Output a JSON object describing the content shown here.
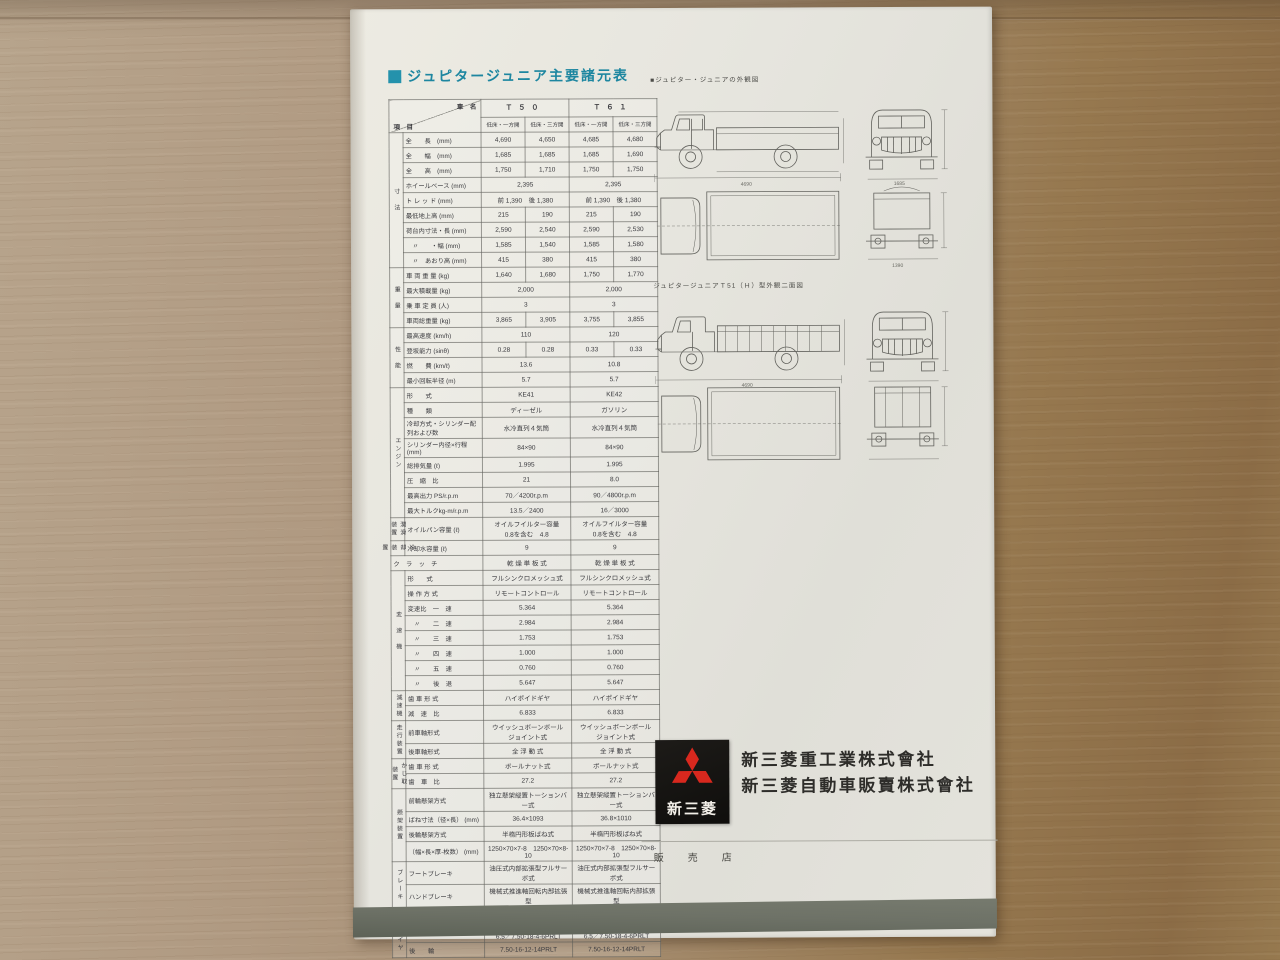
{
  "colors": {
    "accent_teal": "#2492ac",
    "logo_red": "#d8281e",
    "logo_black": "#141210",
    "band_gray": "#6a6e64",
    "paper": "#e6e5df",
    "ink": "#3a3a3e",
    "wood_light": "#b7a48c",
    "wood_dark": "#8b6c46"
  },
  "title": {
    "text": "ジュピタージュニア主要諸元表"
  },
  "drawings": {
    "caption1": "■ジュピター・ジュニアの外観図",
    "caption2": "ジュピタージュニアＴ51（Ｈ）型外観二面図",
    "dims": [
      "4690",
      "1685",
      "2395",
      "1750",
      "1390",
      "2000",
      "215",
      "1585"
    ]
  },
  "table": {
    "corner_top": "車　名",
    "corner_bottom": "項　目",
    "models": [
      "Ｔ５０",
      "Ｔ６１"
    ],
    "sub": [
      "低床・一方開",
      "低床・三方開",
      "低床・一方開",
      "低床・三方開"
    ],
    "sections": [
      {
        "name": "寸　法",
        "rows": [
          {
            "label": "全　　長　(mm)",
            "values": [
              "4,690",
              "4,650",
              "4,685",
              "4,680"
            ]
          },
          {
            "label": "全　　幅　(mm)",
            "values": [
              "1,685",
              "1,685",
              "1,685",
              "1,690"
            ]
          },
          {
            "label": "全　　高　(mm)",
            "values": [
              "1,750",
              "1,710",
              "1,750",
              "1,750"
            ]
          },
          {
            "label": "ホイールベース (mm)",
            "values": [
              "2,395",
              "2,395"
            ]
          },
          {
            "label": "ト レ ッ ド (mm)",
            "values": [
              "前 1,390　後 1,380",
              "前 1,390　後 1,380"
            ]
          },
          {
            "label": "最低地上高 (mm)",
            "values": [
              "215",
              "190",
              "215",
              "190"
            ]
          },
          {
            "label": "荷台内寸法・長 (mm)",
            "values": [
              "2,590",
              "2,540",
              "2,590",
              "2,530"
            ]
          },
          {
            "label": "　〃　　・幅 (mm)",
            "values": [
              "1,585",
              "1,540",
              "1,585",
              "1,580"
            ]
          },
          {
            "label": "　〃　あおり高 (mm)",
            "values": [
              "415",
              "380",
              "415",
              "380"
            ]
          }
        ]
      },
      {
        "name": "重　量",
        "rows": [
          {
            "label": "車 両 重 量 (kg)",
            "values": [
              "1,640",
              "1,680",
              "1,750",
              "1,770"
            ]
          },
          {
            "label": "最大積載量 (kg)",
            "values": [
              "2,000",
              "2,000"
            ]
          },
          {
            "label": "乗 車 定 員 (人)",
            "values": [
              "3",
              "3"
            ]
          },
          {
            "label": "車両総重量 (kg)",
            "values": [
              "3,865",
              "3,905",
              "3,755",
              "3,855"
            ]
          }
        ]
      },
      {
        "name": "性　能",
        "rows": [
          {
            "label": "最高速度 (km/h)",
            "values": [
              "110",
              "120"
            ]
          },
          {
            "label": "登坂能力 (sinθ)",
            "values": [
              "0.28",
              "0.28",
              "0.33",
              "0.33"
            ]
          },
          {
            "label": "燃　　費 (km/ℓ)",
            "values": [
              "13.6",
              "10.8"
            ]
          },
          {
            "label": "最小回転半径 (m)",
            "values": [
              "5.7",
              "5.7"
            ]
          }
        ]
      },
      {
        "name": "エンジン",
        "rows": [
          {
            "label": "形　　式",
            "values": [
              "KE41",
              "KE42"
            ]
          },
          {
            "label": "種　　類",
            "values": [
              "ディーゼル",
              "ガソリン"
            ]
          },
          {
            "label": "冷却方式・シリンダー配列および数",
            "values": [
              "水冷直列４気筒",
              "水冷直列４気筒"
            ]
          },
          {
            "label": "シリンダー内径×行程 (mm)",
            "values": [
              "84×90",
              "84×90"
            ]
          },
          {
            "label": "総排気量 (ℓ)",
            "values": [
              "1.995",
              "1.995"
            ]
          },
          {
            "label": "圧　縮　比",
            "values": [
              "21",
              "8.0"
            ]
          },
          {
            "label": "最高出力 PS/r.p.m",
            "values": [
              "70／4200r.p.m",
              "90／4800r.p.m"
            ]
          },
          {
            "label": "最大トルクkg-m/r.p.m",
            "values": [
              "13.5／2400",
              "16／3000"
            ]
          }
        ]
      },
      {
        "name": "潤滑装置",
        "rows": [
          {
            "label": "オイルパン容量 (ℓ)",
            "values": [
              "オイルフイルター容量\n0.8を含む　4.8",
              "オイルフイルター容量\n0.8を含む　4.8"
            ]
          }
        ]
      },
      {
        "name": "冷却装置",
        "rows": [
          {
            "label": "冷却水容量 (ℓ)",
            "values": [
              "9",
              "9"
            ]
          }
        ]
      },
      {
        "name": "",
        "rows": [
          {
            "label": "ク　ラ　ッ　チ",
            "values": [
              "乾 燥 単 板 式",
              "乾 燥 単 板 式"
            ]
          }
        ]
      },
      {
        "name": "変　速　機",
        "rows": [
          {
            "label": "形　　式",
            "values": [
              "フルシンクロメッシュ式",
              "フルシンクロメッシュ式"
            ]
          },
          {
            "label": "操 作 方 式",
            "values": [
              "リモートコントロール",
              "リモートコントロール"
            ]
          },
          {
            "label": "変速比　一　速",
            "values": [
              "5.364",
              "5.364"
            ]
          },
          {
            "label": "　〃　　二　速",
            "values": [
              "2.984",
              "2.984"
            ]
          },
          {
            "label": "　〃　　三　速",
            "values": [
              "1.753",
              "1.753"
            ]
          },
          {
            "label": "　〃　　四　速",
            "values": [
              "1.000",
              "1.000"
            ]
          },
          {
            "label": "　〃　　五　速",
            "values": [
              "0.760",
              "0.760"
            ]
          },
          {
            "label": "　〃　　後　退",
            "values": [
              "5.647",
              "5.647"
            ]
          }
        ]
      },
      {
        "name": "減速機",
        "rows": [
          {
            "label": "歯 車 形 式",
            "values": [
              "ハイポイドギヤ",
              "ハイポイドギヤ"
            ]
          },
          {
            "label": "減　速　比",
            "values": [
              "6.833",
              "6.833"
            ]
          }
        ]
      },
      {
        "name": "走行装置",
        "rows": [
          {
            "label": "前車軸形式",
            "values": [
              "ウイッシュボーンボール\nジョイント式",
              "ウイッシュボーンボール\nジョイント式"
            ]
          },
          {
            "label": "後車軸形式",
            "values": [
              "全 浮 動 式",
              "全 浮 動 式"
            ]
          }
        ]
      },
      {
        "name": "かじ取装置",
        "rows": [
          {
            "label": "歯 車 形 式",
            "values": [
              "ボールナット式",
              "ボールナット式"
            ]
          },
          {
            "label": "歯　車　比",
            "values": [
              "27.2",
              "27.2"
            ]
          }
        ]
      },
      {
        "name": "懸架装置",
        "rows": [
          {
            "label": "前輪懸架方式",
            "values": [
              "独立懸架縦置トーションバー式",
              "独立懸架縦置トーションバー式"
            ]
          },
          {
            "label": "ばね寸法（径×長） (mm)",
            "values": [
              "36.4×1093",
              "36.8×1010"
            ]
          },
          {
            "label": "後輪懸架方式",
            "values": [
              "半楕円形板ばね式",
              "半楕円形板ばね式"
            ]
          },
          {
            "label": "（幅×長×厚-枚数） (mm)",
            "values": [
              "1250×70×7-8　1250×70×8-10",
              "1250×70×7-8　1250×70×8-10"
            ]
          }
        ]
      },
      {
        "name": "ブレーキ",
        "rows": [
          {
            "label": "フートブレーキ",
            "values": [
              "油圧式内部拡張型フルサーボ式",
              "油圧式内部拡張型フルサーボ式"
            ]
          },
          {
            "label": "ハンドブレーキ",
            "values": [
              "機械式推進軸回転内部拡張型",
              "機械式推進軸回転内部拡張型"
            ]
          }
        ]
      },
      {
        "name": "",
        "rows": [
          {
            "label": "ホ　イ　ー　ル",
            "values": [
              "鋼　板　式",
              "鋼　板　式"
            ]
          }
        ]
      },
      {
        "name": "タイヤ",
        "rows": [
          {
            "label": "前　　輪",
            "values": [
              "7.00-16-6-10PRLT\n6.5／7.50-18-4-6PRLT",
              "7.00-16-6-10PRLT\n6.5／7.50-18-4-6PRLT"
            ]
          },
          {
            "label": "後　　輪",
            "values": [
              "7.50-16-12-14PRLT",
              "7.50-16-12-14PRLT"
            ]
          }
        ]
      }
    ]
  },
  "footer": {
    "logo_text": "新三菱",
    "company_line1": "新三菱重工業株式會社",
    "company_line2": "新三菱自動車販賣株式會社",
    "dealer_label": "販　売　店"
  }
}
